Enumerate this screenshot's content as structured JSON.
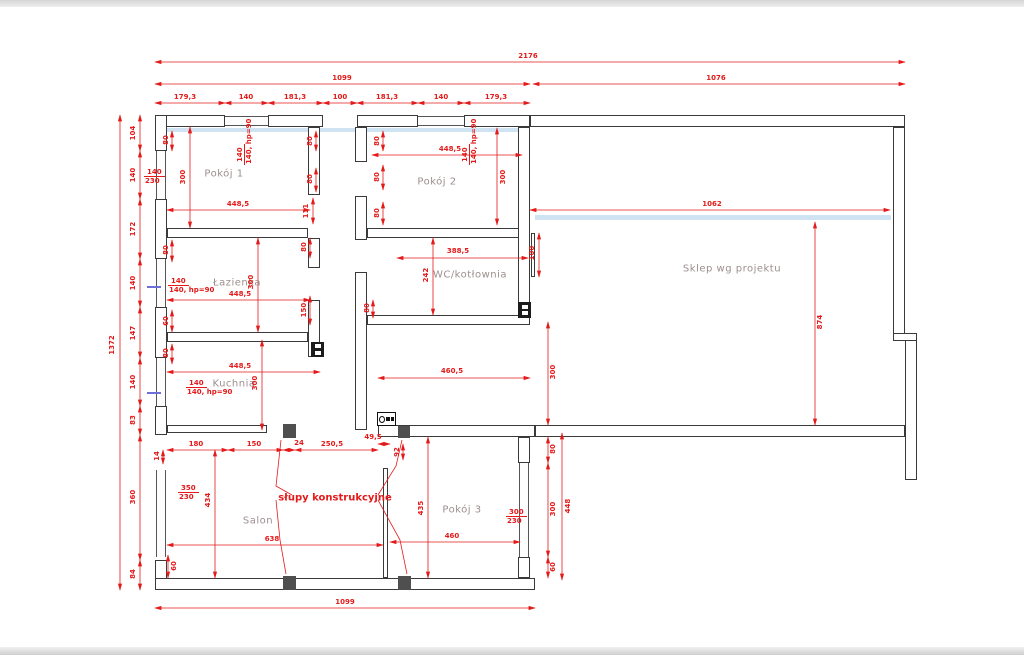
{
  "drawing": {
    "type": "architectural floor plan",
    "units": "cm",
    "colors": {
      "dimension_red": "#e41a1a",
      "room_label": "#9d8e8e",
      "wall": "#3a3a3a",
      "glass_highlight": "#cfe3f3",
      "purple_tick": "#6f6fd8",
      "column_fill": "#4f4f4f",
      "edge_band": "#d8d8d8"
    },
    "rooms": [
      {
        "id": "pokoj-1",
        "label": "Pokój 1",
        "x": 224,
        "y": 174
      },
      {
        "id": "pokoj-2",
        "label": "Pokój 2",
        "x": 437,
        "y": 182
      },
      {
        "id": "lazienka",
        "label": "Łazienka",
        "x": 237,
        "y": 283
      },
      {
        "id": "kuchnia",
        "label": "Kuchnia",
        "x": 234,
        "y": 384
      },
      {
        "id": "wc-kotlownia",
        "label": "WC/kotłownia",
        "x": 470,
        "y": 275
      },
      {
        "id": "sklep",
        "label": "Sklep wg projektu",
        "x": 732,
        "y": 269
      },
      {
        "id": "salon",
        "label": "Salon",
        "x": 258,
        "y": 521
      },
      {
        "id": "pokoj-3",
        "label": "Pokój 3",
        "x": 462,
        "y": 510
      }
    ],
    "annotation": {
      "label": "słupy konstrukcyjne",
      "x": 335,
      "y": 498
    },
    "walls": [
      [
        155,
        115,
        70,
        12
      ],
      [
        268,
        115,
        55,
        12
      ],
      [
        357,
        115,
        61,
        12
      ],
      [
        464,
        115,
        66,
        12
      ],
      [
        530,
        115,
        375,
        12
      ],
      [
        155,
        115,
        12,
        36
      ],
      [
        155,
        199,
        12,
        60
      ],
      [
        155,
        307,
        12,
        51
      ],
      [
        155,
        406,
        12,
        29
      ],
      [
        155,
        560,
        12,
        30
      ],
      [
        155,
        578,
        380,
        12
      ],
      [
        893,
        127,
        12,
        210
      ],
      [
        893,
        333,
        24,
        8
      ],
      [
        905,
        340,
        12,
        140
      ],
      [
        535,
        425,
        370,
        12
      ],
      [
        378,
        425,
        157,
        12
      ],
      [
        518,
        437,
        12,
        26
      ],
      [
        518,
        557,
        12,
        21
      ],
      [
        308,
        127,
        12,
        68
      ],
      [
        308,
        238,
        12,
        30
      ],
      [
        308,
        300,
        12,
        57
      ],
      [
        355,
        127,
        12,
        35
      ],
      [
        355,
        196,
        12,
        44
      ],
      [
        355,
        272,
        12,
        158
      ],
      [
        167,
        228,
        141,
        10
      ],
      [
        367,
        228,
        163,
        10
      ],
      [
        167,
        332,
        141,
        10
      ],
      [
        367,
        315,
        163,
        10
      ],
      [
        518,
        127,
        12,
        191
      ]
    ],
    "thin_walls": [
      [
        167,
        425,
        100,
        8
      ],
      [
        531,
        233,
        4,
        44
      ],
      [
        383,
        468,
        5,
        110
      ]
    ],
    "windows_h": [
      [
        225,
        116,
        43,
        10
      ],
      [
        418,
        116,
        46,
        10
      ]
    ],
    "windows_v": [
      [
        156,
        151,
        10,
        48
      ],
      [
        156,
        259,
        10,
        48
      ],
      [
        156,
        358,
        10,
        48
      ],
      [
        156,
        470,
        10,
        87
      ],
      [
        519,
        463,
        10,
        94
      ]
    ],
    "glass_bands": [
      [
        167,
        128,
        360,
        4
      ],
      [
        535,
        215,
        356,
        5
      ]
    ],
    "purple_ticks": [
      [
        147,
        286,
        14,
        2
      ],
      [
        147,
        392,
        14,
        2
      ]
    ],
    "columns": [
      [
        283,
        424,
        13,
        14
      ],
      [
        398,
        426,
        12,
        12
      ],
      [
        283,
        576,
        13,
        14
      ],
      [
        398,
        576,
        13,
        14
      ]
    ],
    "chimneys": [
      [
        311,
        342,
        13,
        15
      ],
      [
        518,
        302,
        13,
        16
      ]
    ],
    "stove": [
      377,
      412,
      19,
      14
    ],
    "dims": [
      [
        155,
        62,
        905,
        62,
        "2176",
        528,
        56,
        0
      ],
      [
        155,
        84,
        530,
        84,
        "1099",
        342,
        78,
        0
      ],
      [
        533,
        84,
        905,
        84,
        "1076",
        716,
        78,
        0
      ],
      [
        155,
        103,
        225,
        103,
        "179,3",
        185,
        97,
        0
      ],
      [
        225,
        103,
        268,
        103,
        "140",
        246,
        97,
        0
      ],
      [
        268,
        103,
        323,
        103,
        "181,3",
        295,
        97,
        0
      ],
      [
        323,
        103,
        357,
        103,
        "100",
        340,
        97,
        0
      ],
      [
        357,
        103,
        418,
        103,
        "181,3",
        387,
        97,
        0
      ],
      [
        418,
        103,
        464,
        103,
        "140",
        441,
        97,
        0
      ],
      [
        464,
        103,
        530,
        103,
        "179,3",
        496,
        97,
        0
      ],
      [
        120,
        115,
        120,
        590,
        "1372",
        112,
        345,
        1
      ],
      [
        140,
        115,
        140,
        151,
        "104",
        133,
        133,
        1
      ],
      [
        140,
        151,
        140,
        199,
        "140",
        133,
        175,
        1
      ],
      [
        140,
        199,
        140,
        259,
        "172",
        133,
        229,
        1
      ],
      [
        140,
        259,
        140,
        307,
        "140",
        133,
        283,
        1
      ],
      [
        140,
        307,
        140,
        358,
        "147",
        133,
        333,
        1
      ],
      [
        140,
        358,
        140,
        406,
        "140",
        133,
        382,
        1
      ],
      [
        140,
        406,
        140,
        435,
        "83",
        133,
        420,
        1
      ],
      [
        140,
        435,
        140,
        560,
        "360",
        133,
        497,
        1
      ],
      [
        140,
        560,
        140,
        590,
        "84",
        133,
        574,
        1
      ],
      [
        155,
        608,
        535,
        608,
        "1099",
        345,
        602,
        0
      ],
      [
        167,
        210,
        310,
        210,
        "448,5",
        238,
        204,
        0
      ],
      [
        190,
        127,
        190,
        228,
        "300",
        183,
        177,
        1
      ],
      [
        313,
        198,
        313,
        224,
        "111",
        306,
        211,
        1
      ],
      [
        372,
        155,
        522,
        155,
        "448,5",
        450,
        149,
        0
      ],
      [
        497,
        128,
        497,
        225,
        "300",
        503,
        177,
        1
      ],
      [
        167,
        300,
        310,
        300,
        "448,5",
        240,
        294,
        0
      ],
      [
        258,
        238,
        258,
        332,
        "300",
        251,
        282,
        1
      ],
      [
        167,
        372,
        320,
        372,
        "448,5",
        240,
        366,
        0
      ],
      [
        262,
        340,
        262,
        430,
        "300",
        255,
        383,
        1
      ],
      [
        433,
        238,
        433,
        315,
        "242",
        426,
        275,
        1
      ],
      [
        397,
        258,
        528,
        258,
        "388,5",
        458,
        251,
        0
      ],
      [
        539,
        233,
        539,
        277,
        "100",
        532,
        253,
        1
      ],
      [
        378,
        378,
        530,
        378,
        "460,5",
        452,
        371,
        0
      ],
      [
        548,
        322,
        548,
        425,
        "300",
        553,
        372,
        1
      ],
      [
        530,
        210,
        890,
        210,
        "1062",
        712,
        204,
        0
      ],
      [
        815,
        222,
        815,
        425,
        "874",
        820,
        322,
        1
      ],
      [
        167,
        450,
        228,
        450,
        "180",
        196,
        444,
        0
      ],
      [
        228,
        450,
        283,
        450,
        "150",
        254,
        444,
        0
      ],
      [
        283,
        450,
        295,
        450,
        "24",
        299,
        443,
        0
      ],
      [
        295,
        450,
        378,
        450,
        "250,5",
        332,
        444,
        0
      ],
      [
        378,
        444,
        390,
        444,
        "49,5",
        373,
        437,
        0
      ],
      [
        215,
        450,
        215,
        578,
        "434",
        208,
        500,
        1
      ],
      [
        167,
        545,
        383,
        545,
        "638",
        272,
        539,
        0
      ],
      [
        428,
        437,
        428,
        578,
        "435",
        421,
        508,
        1
      ],
      [
        390,
        542,
        520,
        542,
        "460",
        452,
        536,
        0
      ],
      [
        548,
        437,
        548,
        463,
        "80",
        553,
        449,
        1
      ],
      [
        548,
        463,
        548,
        557,
        "300",
        553,
        509,
        1
      ],
      [
        548,
        557,
        548,
        578,
        "60",
        553,
        567,
        1
      ],
      [
        562,
        433,
        562,
        580,
        "448",
        568,
        506,
        1
      ],
      [
        168,
        555,
        168,
        578,
        "60",
        174,
        566,
        1
      ],
      [
        163,
        450,
        163,
        464,
        "14",
        157,
        456,
        1
      ],
      [
        403,
        444,
        403,
        460,
        "92",
        397,
        452,
        1
      ],
      [
        172,
        131,
        172,
        151,
        "80",
        166,
        140,
        1
      ],
      [
        316,
        131,
        316,
        151,
        "80",
        310,
        141,
        1
      ],
      [
        316,
        168,
        316,
        192,
        "80",
        310,
        179,
        1
      ],
      [
        383,
        131,
        383,
        151,
        "80",
        377,
        141,
        1
      ],
      [
        383,
        165,
        383,
        190,
        "80",
        377,
        177,
        1
      ],
      [
        383,
        202,
        383,
        225,
        "80",
        377,
        213,
        1
      ],
      [
        172,
        240,
        172,
        262,
        "80",
        166,
        250,
        1
      ],
      [
        310,
        238,
        310,
        258,
        "80",
        304,
        247,
        1
      ],
      [
        310,
        296,
        310,
        325,
        "150",
        304,
        310,
        1
      ],
      [
        172,
        310,
        172,
        332,
        "60",
        166,
        321,
        1
      ],
      [
        172,
        344,
        172,
        364,
        "80",
        166,
        353,
        1
      ],
      [
        373,
        300,
        373,
        318,
        "80",
        367,
        308,
        1
      ]
    ],
    "fractions": [
      {
        "num": "140",
        "den": "230",
        "x": 144,
        "y": 168,
        "rot": 0
      },
      {
        "num": "140",
        "den": "140, hp=90",
        "x": 168,
        "y": 277,
        "rot": 0
      },
      {
        "num": "140",
        "den": "140, hp=90",
        "x": 186,
        "y": 379,
        "rot": 0
      },
      {
        "num": "350",
        "den": "230",
        "x": 178,
        "y": 484,
        "rot": 0
      },
      {
        "num": "300",
        "den": "230",
        "x": 506,
        "y": 508,
        "rot": 0
      },
      {
        "num": "140",
        "den": "140, hp=90",
        "x": 236,
        "y": 165,
        "rot": 1
      },
      {
        "num": "140",
        "den": "140, hp=90",
        "x": 461,
        "y": 165,
        "rot": 1
      }
    ],
    "leaders": [
      [
        [
          292,
          495
        ],
        [
          276,
          486
        ],
        [
          281,
          440
        ]
      ],
      [
        [
          276,
          500
        ],
        [
          280,
          540
        ],
        [
          286,
          574
        ]
      ],
      [
        [
          378,
          495
        ],
        [
          396,
          466
        ],
        [
          402,
          440
        ]
      ],
      [
        [
          378,
          500
        ],
        [
          400,
          540
        ],
        [
          407,
          574
        ]
      ]
    ]
  }
}
